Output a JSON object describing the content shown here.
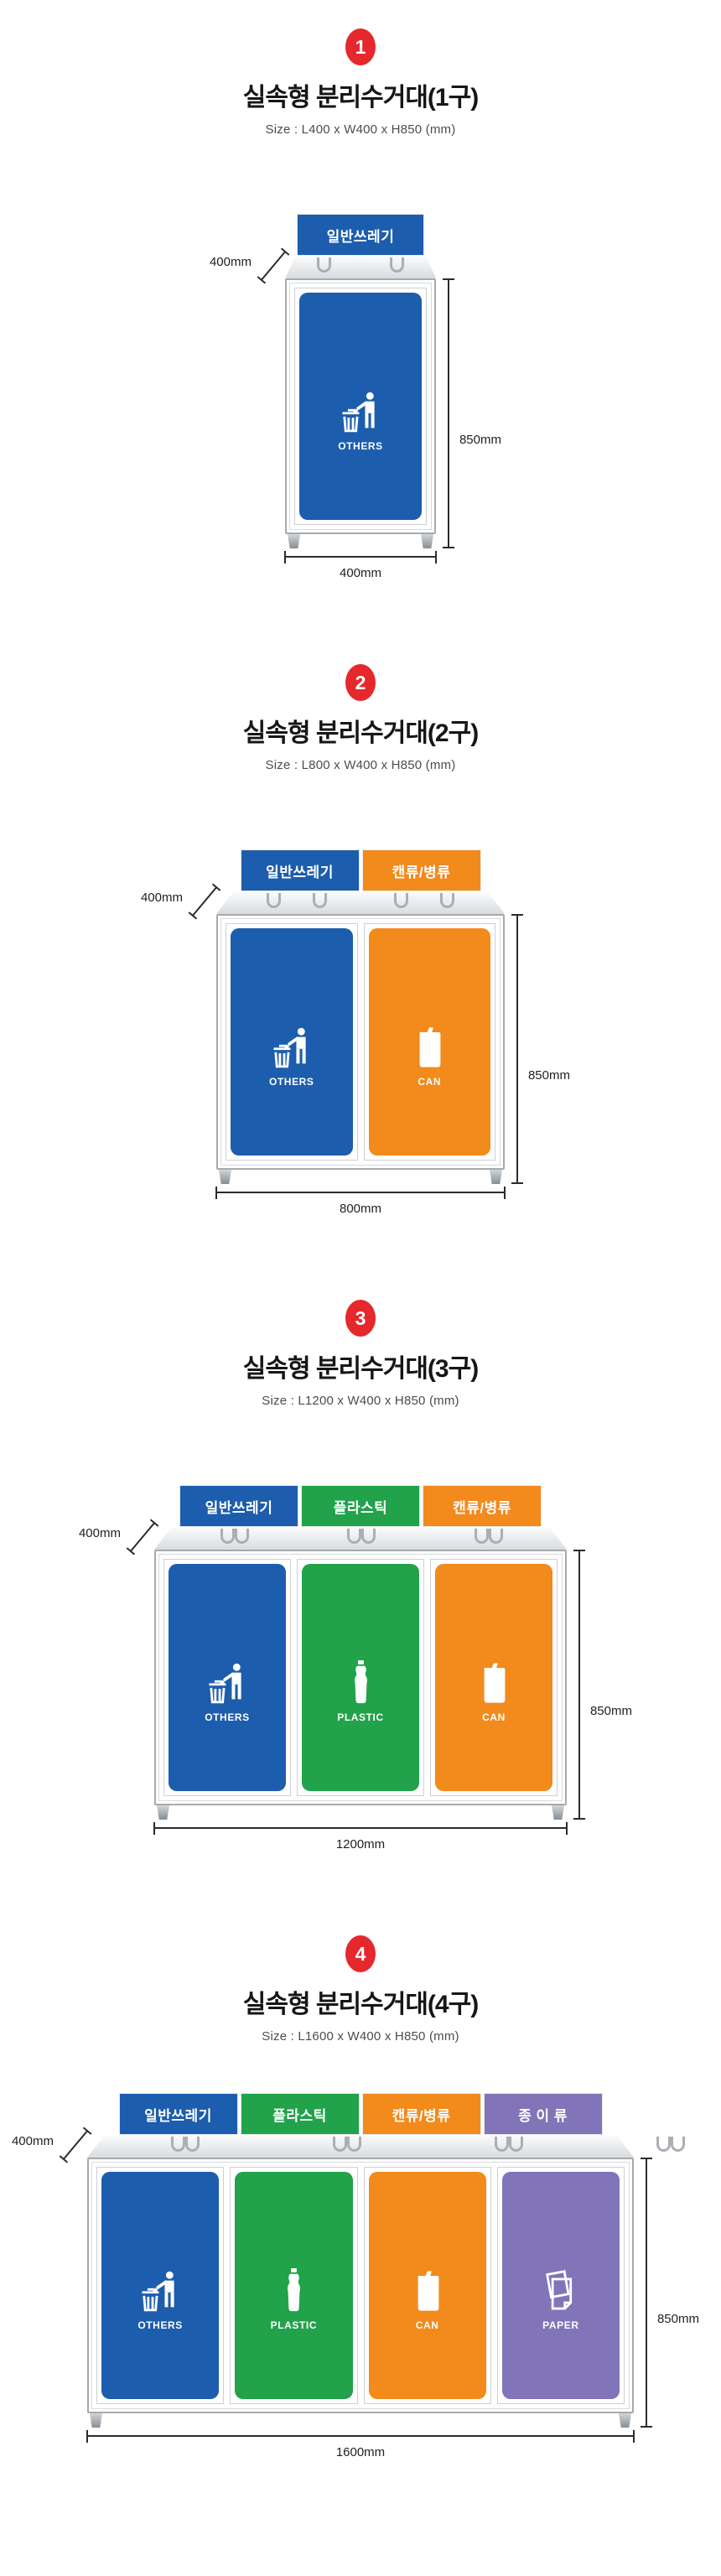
{
  "colors": {
    "badge_red": "#e5282c",
    "blue": "#1d5dad",
    "orange": "#f28a1c",
    "green": "#21a24b",
    "purple": "#8174b9"
  },
  "sections": [
    {
      "number": "1",
      "title": "실속형 분리수거대(1구)",
      "size_label": "Size : L400 x W400 x H850 (mm)",
      "depth_label": "400mm",
      "height_label": "850mm",
      "width_label": "400mm",
      "bins": [
        {
          "sign": "일반쓰레기",
          "label": "OTHERS",
          "color": "#1d5dad",
          "icon": "litter-person-icon"
        }
      ]
    },
    {
      "number": "2",
      "title": "실속형 분리수거대(2구)",
      "size_label": "Size : L800 x W400 x H850 (mm)",
      "depth_label": "400mm",
      "height_label": "850mm",
      "width_label": "800mm",
      "bins": [
        {
          "sign": "일반쓰레기",
          "label": "OTHERS",
          "color": "#1d5dad",
          "icon": "litter-person-icon"
        },
        {
          "sign": "캔류/병류",
          "label": "CAN",
          "color": "#f28a1c",
          "icon": "can-icon"
        }
      ]
    },
    {
      "number": "3",
      "title": "실속형 분리수거대(3구)",
      "size_label": "Size : L1200 x W400 x H850 (mm)",
      "depth_label": "400mm",
      "height_label": "850mm",
      "width_label": "1200mm",
      "bins": [
        {
          "sign": "일반쓰레기",
          "label": "OTHERS",
          "color": "#1d5dad",
          "icon": "litter-person-icon"
        },
        {
          "sign": "플라스틱",
          "label": "PLASTIC",
          "color": "#21a24b",
          "icon": "plastic-bottle-icon"
        },
        {
          "sign": "캔류/병류",
          "label": "CAN",
          "color": "#f28a1c",
          "icon": "can-icon"
        }
      ]
    },
    {
      "number": "4",
      "title": "실속형 분리수거대(4구)",
      "size_label": "Size : L1600 x W400 x H850 (mm)",
      "depth_label": "400mm",
      "height_label": "850mm",
      "width_label": "1600mm",
      "bins": [
        {
          "sign": "일반쓰레기",
          "label": "OTHERS",
          "color": "#1d5dad",
          "icon": "litter-person-icon"
        },
        {
          "sign": "플라스틱",
          "label": "PLASTIC",
          "color": "#21a24b",
          "icon": "plastic-bottle-icon"
        },
        {
          "sign": "캔류/병류",
          "label": "CAN",
          "color": "#f28a1c",
          "icon": "can-icon"
        },
        {
          "sign": "종 이 류",
          "label": "PAPER",
          "color": "#8174b9",
          "icon": "paper-icon"
        }
      ]
    }
  ]
}
